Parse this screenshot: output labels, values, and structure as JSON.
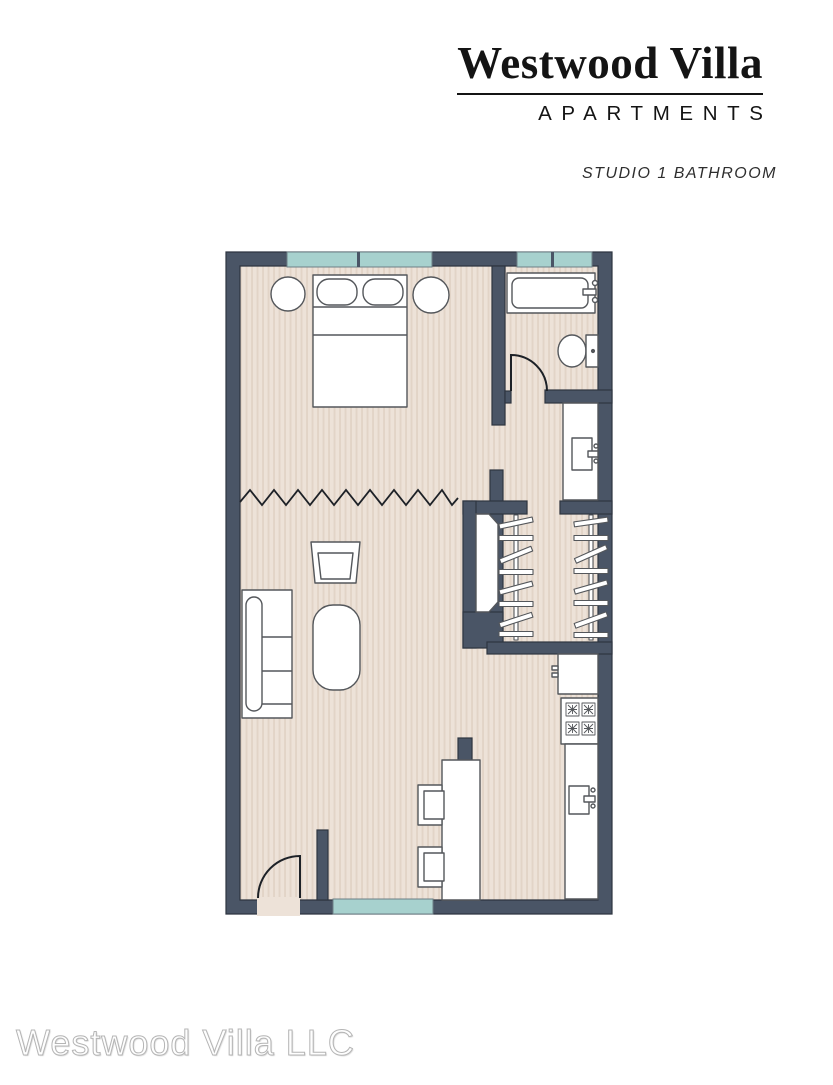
{
  "header": {
    "brand_name": "Westwood Villa",
    "brand_subtitle": "APARTMENTS",
    "unit_label": "STUDIO 1 BATHROOM"
  },
  "footer": {
    "watermark": "Westwood Villa LLC"
  },
  "colors": {
    "wall": "#4a5566",
    "wall_dark_line": "#2e3540",
    "floor": "#ede2d8",
    "floor_stripe": "#e2d4c7",
    "window_glass": "#a7d1ce",
    "window_outline": "#6d8087",
    "fixture_fill": "#ffffff",
    "fixture_stroke": "#54575b",
    "door_swing": "#1d2127",
    "title_color": "#141414",
    "watermark_outline": "#b5b5b5"
  },
  "floor_plan": {
    "label": "Studio 1 Bathroom floor plan",
    "fixtures": [
      "bed",
      "pillows",
      "nightstands",
      "bathtub",
      "toilet",
      "vanity sink",
      "closet rods with hangers",
      "wardrobe",
      "sofa",
      "armchair",
      "coffee table",
      "kitchen island",
      "stools",
      "refrigerator",
      "stove",
      "kitchen sink",
      "entry door",
      "bathroom door",
      "windows",
      "room divider"
    ]
  }
}
